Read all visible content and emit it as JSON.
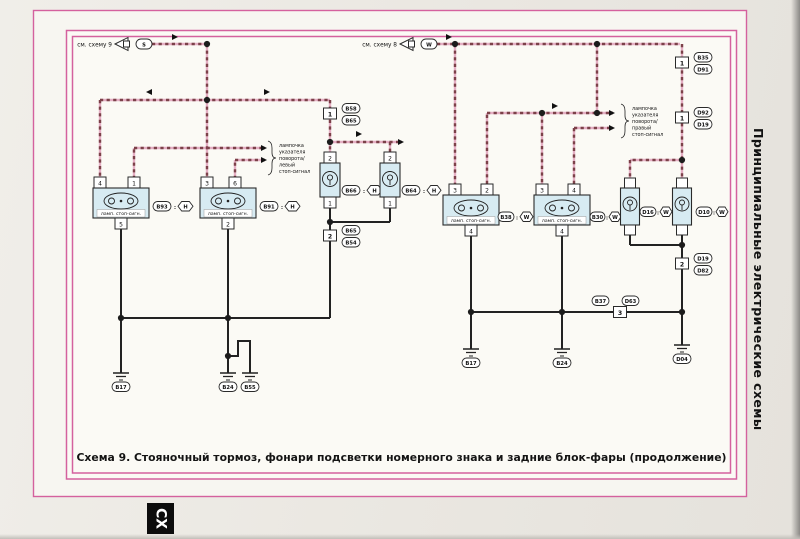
{
  "page": {
    "caption": "Схема 9. Стояночный тормоз, фонари подсветки номерного знака и задние блок-фары (продолжение)",
    "sidebar_title": "Принципиальные электрические схемы",
    "section_tab": "СХ",
    "colors": {
      "frame_pink": "#d4619e",
      "wire_dark": "#7c4149",
      "wire_pink": "#e4aec3",
      "lamp_fill": "#d7ebf2",
      "paper": "#eae7e1"
    }
  },
  "refs": {
    "left": {
      "label": "см. схему 9",
      "wire": "S"
    },
    "right": {
      "label": "см. схему 8",
      "wire": "W"
    }
  },
  "notes": {
    "left": {
      "l1": "лампочка",
      "l2": "указателя",
      "l3": "поворота/",
      "l4": "левый",
      "l5": "стоп-сигнал"
    },
    "right": {
      "l1": "лампочка",
      "l2": "указателя",
      "l3": "поворота/",
      "l4": "правый",
      "l5": "стоп-сигнал"
    }
  },
  "sep": ":",
  "lamps": {
    "stop_left_1": {
      "label": "ламп. стоп-сигн.",
      "pin_top1": "4",
      "pin_top2": "1",
      "pin_bottom": "5",
      "code": "B93",
      "wire": "H"
    },
    "stop_left_2": {
      "label": "ламп. стоп-сигн.",
      "pin_top1": "3",
      "pin_top2": "6",
      "pin_bottom": "2",
      "code": "B91",
      "wire": "H"
    },
    "small_left_1": {
      "pin_top": "2",
      "pin_bottom": "1",
      "code": "B66",
      "wire": "H"
    },
    "small_left_2": {
      "pin_top": "2",
      "pin_bottom": "1",
      "code": "B64",
      "wire": "H"
    },
    "stop_right_1": {
      "label": "ламп. стоп-сигн.",
      "pin_top1": "3",
      "pin_top2": "2",
      "pin_bottom": "4",
      "code": "B38",
      "wire": "W"
    },
    "stop_right_2": {
      "label": "ламп. стоп-сигн.",
      "pin_top1": "3",
      "pin_top2": "4",
      "pin_bottom": "4",
      "code": "B30",
      "wire": "W"
    },
    "plate_right_1": {
      "code": "D16",
      "wire": "W"
    },
    "plate_right_2": {
      "code": "D10",
      "wire": "W"
    }
  },
  "connectors": {
    "c1": {
      "num": "1",
      "top": "B58",
      "bottom": "B65"
    },
    "c2": {
      "num": "2",
      "top": "B65",
      "bottom": "B54"
    },
    "c3": {
      "num": "1",
      "top": "B35",
      "bottom": "D91"
    },
    "c4": {
      "num": "1",
      "top": "D92",
      "bottom": "D19"
    },
    "c5": {
      "num": "2",
      "top": "D19",
      "bottom": "D82"
    },
    "c6": {
      "num": "3",
      "left": "B37",
      "right": "D63"
    }
  },
  "grounds": {
    "g1": "B17",
    "g2": "B24",
    "g3": "B55",
    "g4": "B17",
    "g5": "B24",
    "g6": "D04"
  }
}
